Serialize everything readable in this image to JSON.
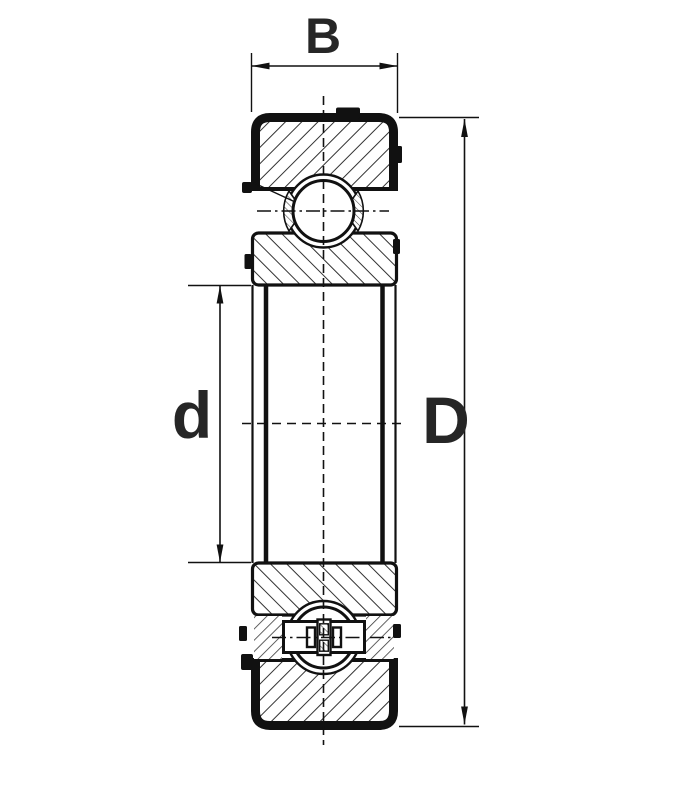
{
  "diagram": {
    "type": "bearing-cross-section",
    "description": "Sectional technical drawing of a deep groove ball bearing with dimension callouts",
    "dimension_labels": {
      "width": "B",
      "bore_diameter": "d",
      "outer_diameter": "D"
    },
    "colors": {
      "background": "#ffffff",
      "line": "#111111",
      "hatch": "#333333",
      "label": "#262626"
    }
  }
}
